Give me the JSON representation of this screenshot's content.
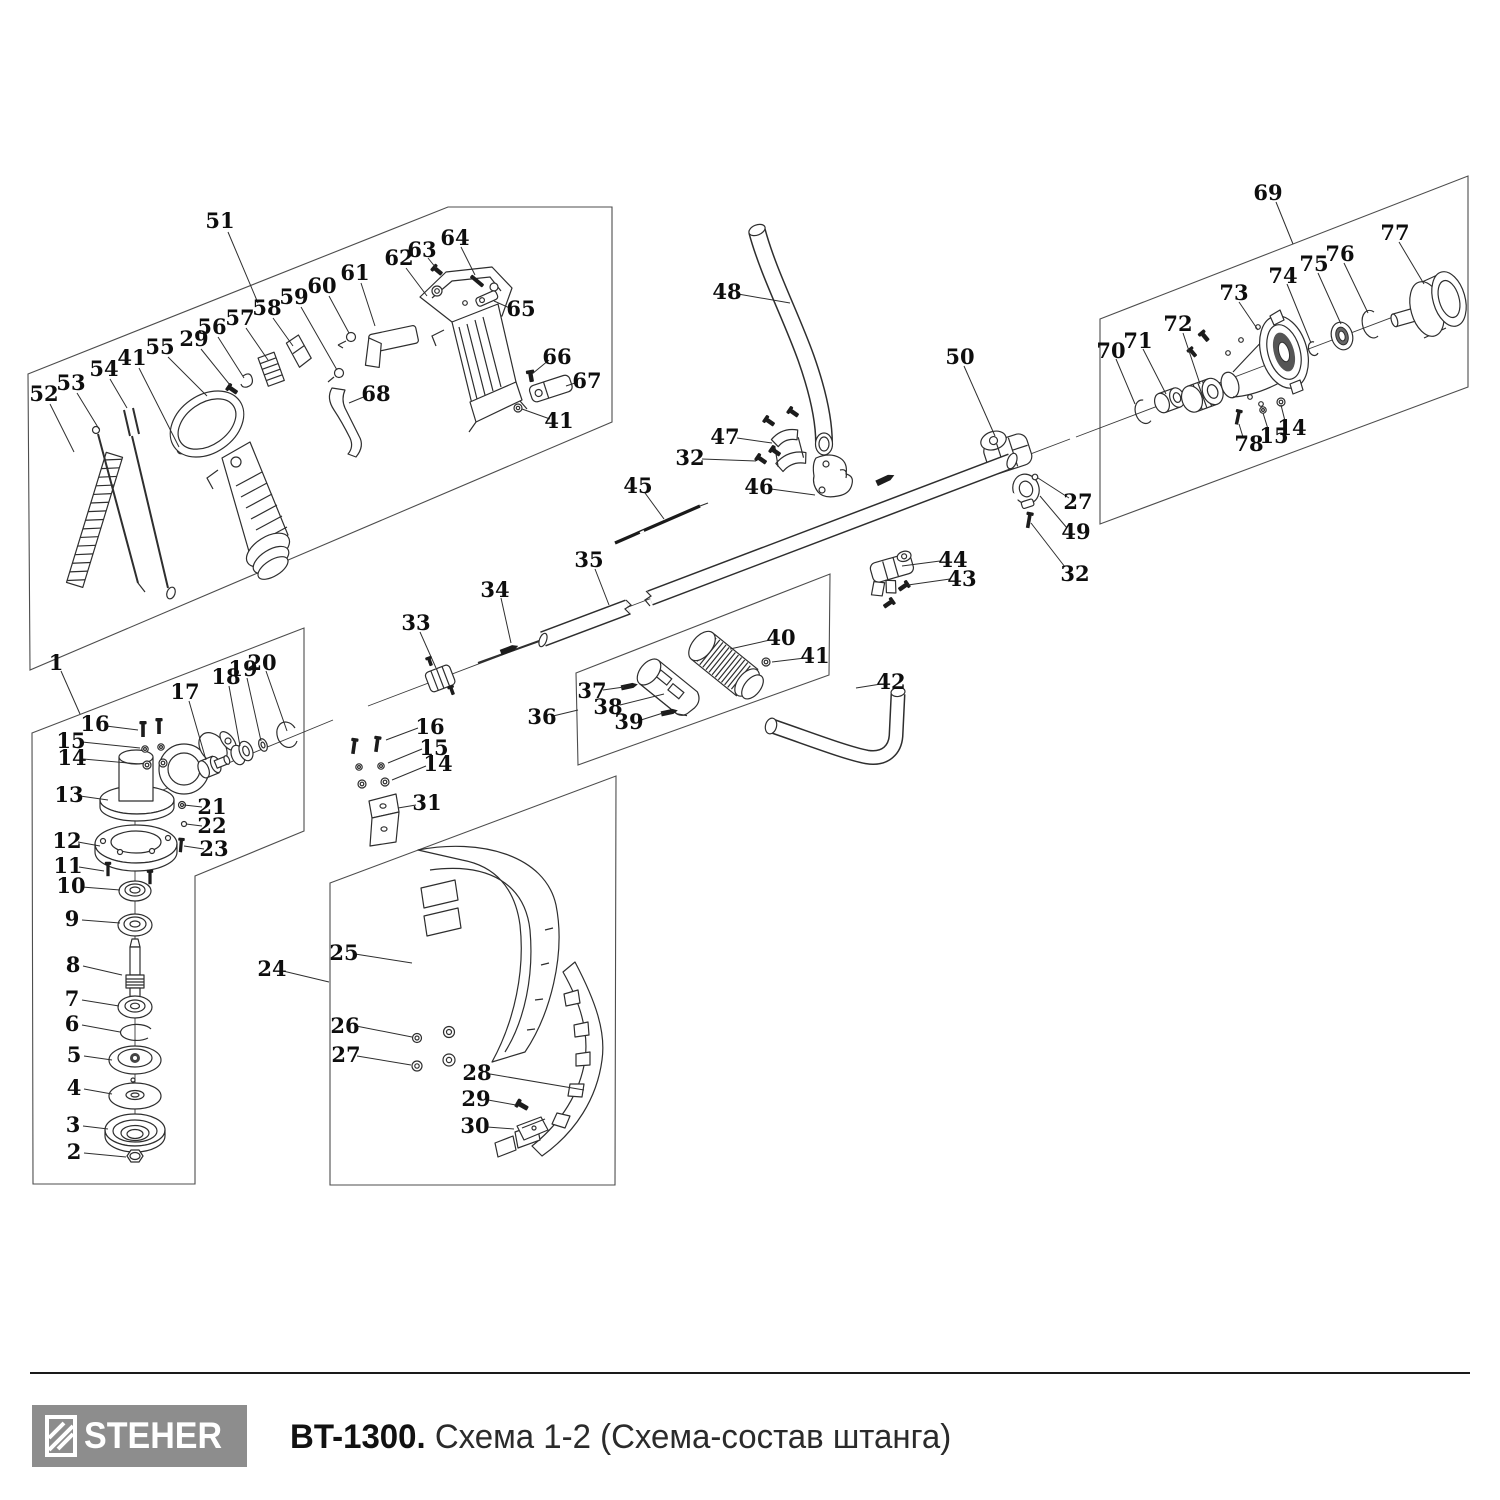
{
  "footer": {
    "brand": "STEHER",
    "model": "BT-1300.",
    "caption": "Схема 1-2 (Схема-состав штанга)"
  },
  "figure": {
    "callouts": [
      {
        "n": "51",
        "tx": 220,
        "ty": 221,
        "lx1": 228,
        "ly1": 232,
        "lx2": 258,
        "ly2": 303
      },
      {
        "n": "52",
        "tx": 44,
        "ty": 394,
        "lx1": 50,
        "ly1": 404,
        "lx2": 74,
        "ly2": 452
      },
      {
        "n": "53",
        "tx": 71,
        "ty": 383,
        "lx1": 77,
        "ly1": 393,
        "lx2": 99,
        "ly2": 429
      },
      {
        "n": "54",
        "tx": 104,
        "ty": 369,
        "lx1": 110,
        "ly1": 379,
        "lx2": 127,
        "ly2": 408
      },
      {
        "n": "41",
        "tx": 132,
        "ty": 358,
        "lx1": 139,
        "ly1": 368,
        "lx2": 179,
        "ly2": 447
      },
      {
        "n": "55",
        "tx": 160,
        "ty": 347,
        "lx1": 168,
        "ly1": 357,
        "lx2": 207,
        "ly2": 396
      },
      {
        "n": "29",
        "tx": 194,
        "ty": 339,
        "lx1": 201,
        "ly1": 349,
        "lx2": 230,
        "ly2": 385
      },
      {
        "n": "56",
        "tx": 212,
        "ty": 327,
        "lx1": 218,
        "ly1": 337,
        "lx2": 244,
        "ly2": 378
      },
      {
        "n": "57",
        "tx": 240,
        "ty": 318,
        "lx1": 246,
        "ly1": 328,
        "lx2": 268,
        "ly2": 360
      },
      {
        "n": "58",
        "tx": 267,
        "ty": 308,
        "lx1": 273,
        "ly1": 318,
        "lx2": 293,
        "ly2": 346
      },
      {
        "n": "59",
        "tx": 294,
        "ty": 297,
        "lx1": 301,
        "ly1": 307,
        "lx2": 337,
        "ly2": 370
      },
      {
        "n": "60",
        "tx": 322,
        "ty": 286,
        "lx1": 329,
        "ly1": 296,
        "lx2": 349,
        "ly2": 333
      },
      {
        "n": "61",
        "tx": 355,
        "ty": 273,
        "lx1": 361,
        "ly1": 283,
        "lx2": 375,
        "ly2": 326
      },
      {
        "n": "62",
        "tx": 399,
        "ty": 258,
        "lx1": 406,
        "ly1": 268,
        "lx2": 427,
        "ly2": 296
      },
      {
        "n": "63",
        "tx": 422,
        "ty": 250,
        "lx1": 428,
        "ly1": 258,
        "lx2": 436,
        "ly2": 268
      },
      {
        "n": "64",
        "tx": 455,
        "ty": 238,
        "lx1": 461,
        "ly1": 247,
        "lx2": 475,
        "ly2": 275
      },
      {
        "n": "65",
        "tx": 521,
        "ty": 309,
        "lx1": 512,
        "ly1": 309,
        "lx2": 494,
        "ly2": 301
      },
      {
        "n": "66",
        "tx": 557,
        "ty": 357,
        "lx1": 549,
        "ly1": 360,
        "lx2": 532,
        "ly2": 374
      },
      {
        "n": "67",
        "tx": 587,
        "ty": 381,
        "lx1": 578,
        "ly1": 382,
        "lx2": 566,
        "ly2": 386
      },
      {
        "n": "68",
        "tx": 376,
        "ty": 394,
        "lx1": 366,
        "ly1": 396,
        "lx2": 349,
        "ly2": 403
      },
      {
        "n": "41",
        "tx": 559,
        "ty": 421,
        "lx1": 550,
        "ly1": 419,
        "lx2": 522,
        "ly2": 409
      },
      {
        "n": "48",
        "tx": 727,
        "ty": 292,
        "lx1": 738,
        "ly1": 294,
        "lx2": 790,
        "ly2": 303
      },
      {
        "n": "47",
        "tx": 725,
        "ty": 437,
        "lx1": 737,
        "ly1": 438,
        "lx2": 772,
        "ly2": 443
      },
      {
        "n": "32",
        "tx": 690,
        "ty": 458,
        "lx1": 702,
        "ly1": 459,
        "lx2": 756,
        "ly2": 461
      },
      {
        "n": "46",
        "tx": 759,
        "ty": 487,
        "lx1": 771,
        "ly1": 489,
        "lx2": 815,
        "ly2": 495
      },
      {
        "n": "45",
        "tx": 638,
        "ty": 486,
        "lx1": 645,
        "ly1": 493,
        "lx2": 664,
        "ly2": 519
      },
      {
        "n": "50",
        "tx": 960,
        "ty": 357,
        "lx1": 964,
        "ly1": 366,
        "lx2": 995,
        "ly2": 436
      },
      {
        "n": "27",
        "tx": 1078,
        "ty": 502,
        "lx1": 1069,
        "ly1": 498,
        "lx2": 1038,
        "ly2": 478
      },
      {
        "n": "49",
        "tx": 1076,
        "ty": 532,
        "lx1": 1067,
        "ly1": 528,
        "lx2": 1040,
        "ly2": 496
      },
      {
        "n": "32",
        "tx": 1075,
        "ty": 574,
        "lx1": 1065,
        "ly1": 567,
        "lx2": 1031,
        "ly2": 523
      },
      {
        "n": "44",
        "tx": 953,
        "ty": 560,
        "lx1": 940,
        "ly1": 561,
        "lx2": 902,
        "ly2": 566
      },
      {
        "n": "43",
        "tx": 962,
        "ty": 579,
        "lx1": 950,
        "ly1": 579,
        "lx2": 908,
        "ly2": 585
      },
      {
        "n": "35",
        "tx": 589,
        "ty": 560,
        "lx1": 595,
        "ly1": 569,
        "lx2": 609,
        "ly2": 605
      },
      {
        "n": "34",
        "tx": 495,
        "ty": 590,
        "lx1": 501,
        "ly1": 598,
        "lx2": 511,
        "ly2": 643
      },
      {
        "n": "33",
        "tx": 416,
        "ty": 623,
        "lx1": 420,
        "ly1": 632,
        "lx2": 436,
        "ly2": 668
      },
      {
        "n": "42",
        "tx": 891,
        "ty": 682,
        "lx1": 881,
        "ly1": 684,
        "lx2": 856,
        "ly2": 688
      },
      {
        "n": "40",
        "tx": 781,
        "ty": 638,
        "lx1": 770,
        "ly1": 640,
        "lx2": 730,
        "ly2": 649
      },
      {
        "n": "41",
        "tx": 815,
        "ty": 656,
        "lx1": 805,
        "ly1": 658,
        "lx2": 772,
        "ly2": 662
      },
      {
        "n": "36",
        "tx": 542,
        "ty": 717,
        "lx1": 553,
        "ly1": 716,
        "lx2": 578,
        "ly2": 710
      },
      {
        "n": "37",
        "tx": 592,
        "ty": 691,
        "lx1": 603,
        "ly1": 690,
        "lx2": 624,
        "ly2": 687
      },
      {
        "n": "38",
        "tx": 608,
        "ty": 707,
        "lx1": 620,
        "ly1": 705,
        "lx2": 664,
        "ly2": 694
      },
      {
        "n": "39",
        "tx": 629,
        "ty": 722,
        "lx1": 641,
        "ly1": 720,
        "lx2": 663,
        "ly2": 713
      },
      {
        "n": "16",
        "tx": 430,
        "ty": 727,
        "lx1": 418,
        "ly1": 728,
        "lx2": 386,
        "ly2": 740
      },
      {
        "n": "15",
        "tx": 434,
        "ty": 748,
        "lx1": 422,
        "ly1": 749,
        "lx2": 388,
        "ly2": 763
      },
      {
        "n": "14",
        "tx": 438,
        "ty": 764,
        "lx1": 426,
        "ly1": 766,
        "lx2": 392,
        "ly2": 780
      },
      {
        "n": "31",
        "tx": 427,
        "ty": 803,
        "lx1": 416,
        "ly1": 805,
        "lx2": 398,
        "ly2": 808
      },
      {
        "n": "69",
        "tx": 1268,
        "ty": 193,
        "lx1": 1276,
        "ly1": 202,
        "lx2": 1293,
        "ly2": 244
      },
      {
        "n": "77",
        "tx": 1395,
        "ty": 233,
        "lx1": 1399,
        "ly1": 242,
        "lx2": 1424,
        "ly2": 284
      },
      {
        "n": "76",
        "tx": 1340,
        "ty": 254,
        "lx1": 1344,
        "ly1": 263,
        "lx2": 1368,
        "ly2": 313
      },
      {
        "n": "75",
        "tx": 1314,
        "ty": 264,
        "lx1": 1318,
        "ly1": 273,
        "lx2": 1341,
        "ly2": 324
      },
      {
        "n": "74",
        "tx": 1283,
        "ty": 276,
        "lx1": 1287,
        "ly1": 284,
        "lx2": 1311,
        "ly2": 343
      },
      {
        "n": "73",
        "tx": 1234,
        "ty": 293,
        "lx1": 1239,
        "ly1": 302,
        "lx2": 1258,
        "ly2": 330
      },
      {
        "n": "72",
        "tx": 1178,
        "ty": 324,
        "lx1": 1183,
        "ly1": 333,
        "lx2": 1200,
        "ly2": 384
      },
      {
        "n": "71",
        "tx": 1138,
        "ty": 341,
        "lx1": 1143,
        "ly1": 349,
        "lx2": 1166,
        "ly2": 394
      },
      {
        "n": "70",
        "tx": 1111,
        "ty": 351,
        "lx1": 1116,
        "ly1": 359,
        "lx2": 1135,
        "ly2": 404
      },
      {
        "n": "78",
        "tx": 1249,
        "ty": 444,
        "lx1": 1243,
        "ly1": 437,
        "lx2": 1239,
        "ly2": 424
      },
      {
        "n": "15",
        "tx": 1274,
        "ty": 436,
        "lx1": 1268,
        "ly1": 429,
        "lx2": 1263,
        "ly2": 413
      },
      {
        "n": "14",
        "tx": 1292,
        "ty": 428,
        "lx1": 1285,
        "ly1": 421,
        "lx2": 1281,
        "ly2": 405
      },
      {
        "n": "1",
        "tx": 56,
        "ty": 663,
        "lx1": 61,
        "ly1": 671,
        "lx2": 80,
        "ly2": 714
      },
      {
        "n": "16",
        "tx": 95,
        "ty": 724,
        "lx1": 106,
        "ly1": 726,
        "lx2": 138,
        "ly2": 730
      },
      {
        "n": "15",
        "tx": 71,
        "ty": 741,
        "lx1": 82,
        "ly1": 742,
        "lx2": 140,
        "ly2": 748
      },
      {
        "n": "14",
        "tx": 72,
        "ty": 758,
        "lx1": 83,
        "ly1": 759,
        "lx2": 140,
        "ly2": 764
      },
      {
        "n": "17",
        "tx": 185,
        "ty": 692,
        "lx1": 189,
        "ly1": 701,
        "lx2": 206,
        "ly2": 760
      },
      {
        "n": "18",
        "tx": 226,
        "ty": 677,
        "lx1": 229,
        "ly1": 686,
        "lx2": 240,
        "ly2": 746
      },
      {
        "n": "19",
        "tx": 243,
        "ty": 669,
        "lx1": 247,
        "ly1": 678,
        "lx2": 261,
        "ly2": 741
      },
      {
        "n": "20",
        "tx": 262,
        "ty": 663,
        "lx1": 266,
        "ly1": 671,
        "lx2": 287,
        "ly2": 731
      },
      {
        "n": "13",
        "tx": 69,
        "ty": 795,
        "lx1": 80,
        "ly1": 796,
        "lx2": 108,
        "ly2": 800
      },
      {
        "n": "21",
        "tx": 212,
        "ty": 807,
        "lx1": 202,
        "ly1": 807,
        "lx2": 184,
        "ly2": 805
      },
      {
        "n": "22",
        "tx": 212,
        "ty": 826,
        "lx1": 202,
        "ly1": 826,
        "lx2": 186,
        "ly2": 824
      },
      {
        "n": "23",
        "tx": 214,
        "ty": 849,
        "lx1": 204,
        "ly1": 849,
        "lx2": 184,
        "ly2": 846
      },
      {
        "n": "12",
        "tx": 67,
        "ty": 841,
        "lx1": 78,
        "ly1": 842,
        "lx2": 100,
        "ly2": 846
      },
      {
        "n": "11",
        "tx": 68,
        "ty": 866,
        "lx1": 79,
        "ly1": 867,
        "lx2": 104,
        "ly2": 871
      },
      {
        "n": "10",
        "tx": 71,
        "ty": 886,
        "lx1": 82,
        "ly1": 887,
        "lx2": 120,
        "ly2": 890
      },
      {
        "n": "9",
        "tx": 72,
        "ty": 919,
        "lx1": 82,
        "ly1": 920,
        "lx2": 120,
        "ly2": 923
      },
      {
        "n": "8",
        "tx": 73,
        "ty": 965,
        "lx1": 83,
        "ly1": 966,
        "lx2": 122,
        "ly2": 975
      },
      {
        "n": "7",
        "tx": 72,
        "ty": 999,
        "lx1": 82,
        "ly1": 1000,
        "lx2": 119,
        "ly2": 1006
      },
      {
        "n": "6",
        "tx": 72,
        "ty": 1024,
        "lx1": 82,
        "ly1": 1025,
        "lx2": 120,
        "ly2": 1032
      },
      {
        "n": "5",
        "tx": 74,
        "ty": 1055,
        "lx1": 84,
        "ly1": 1056,
        "lx2": 112,
        "ly2": 1060
      },
      {
        "n": "4",
        "tx": 74,
        "ty": 1088,
        "lx1": 84,
        "ly1": 1089,
        "lx2": 112,
        "ly2": 1094
      },
      {
        "n": "3",
        "tx": 73,
        "ty": 1125,
        "lx1": 83,
        "ly1": 1126,
        "lx2": 108,
        "ly2": 1129
      },
      {
        "n": "2",
        "tx": 74,
        "ty": 1152,
        "lx1": 84,
        "ly1": 1153,
        "lx2": 126,
        "ly2": 1157
      },
      {
        "n": "24",
        "tx": 272,
        "ty": 969,
        "lx1": 283,
        "ly1": 971,
        "lx2": 329,
        "ly2": 982
      },
      {
        "n": "25",
        "tx": 344,
        "ty": 953,
        "lx1": 355,
        "ly1": 954,
        "lx2": 412,
        "ly2": 963
      },
      {
        "n": "26",
        "tx": 345,
        "ty": 1026,
        "lx1": 356,
        "ly1": 1026,
        "lx2": 412,
        "ly2": 1037
      },
      {
        "n": "27",
        "tx": 346,
        "ty": 1055,
        "lx1": 357,
        "ly1": 1056,
        "lx2": 411,
        "ly2": 1065
      },
      {
        "n": "28",
        "tx": 477,
        "ty": 1073,
        "lx1": 490,
        "ly1": 1074,
        "lx2": 584,
        "ly2": 1090
      },
      {
        "n": "29",
        "tx": 476,
        "ty": 1099,
        "lx1": 488,
        "ly1": 1100,
        "lx2": 516,
        "ly2": 1105
      },
      {
        "n": "30",
        "tx": 475,
        "ty": 1126,
        "lx1": 487,
        "ly1": 1127,
        "lx2": 514,
        "ly2": 1129
      }
    ]
  }
}
